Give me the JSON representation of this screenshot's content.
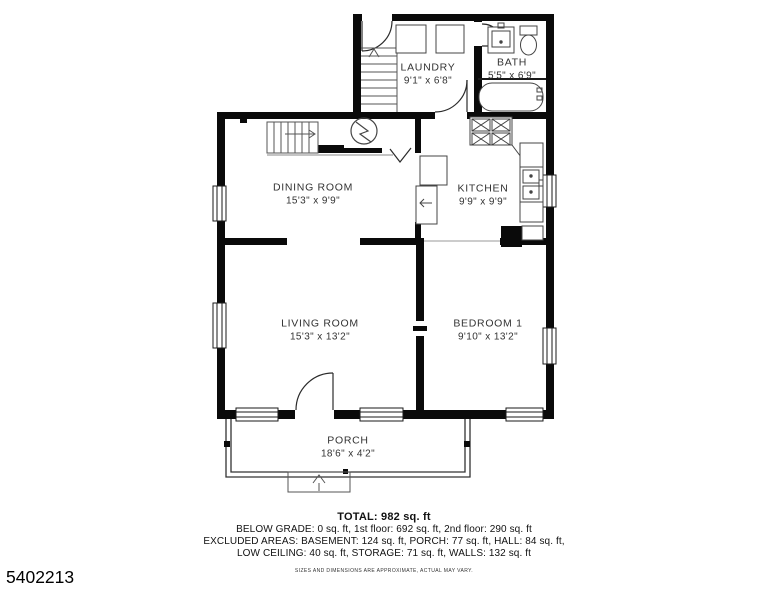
{
  "floor_plan": {
    "listing_id": "5402213",
    "rooms": [
      {
        "id": "laundry",
        "name": "LAUNDRY",
        "dims": "9'1\" x 6'8\""
      },
      {
        "id": "bath",
        "name": "BATH",
        "dims": "5'5\" x 6'9\""
      },
      {
        "id": "dining",
        "name": "DINING ROOM",
        "dims": "15'3\" x 9'9\""
      },
      {
        "id": "kitchen",
        "name": "KITCHEN",
        "dims": "9'9\" x 9'9\""
      },
      {
        "id": "living",
        "name": "LIVING ROOM",
        "dims": "15'3\" x 13'2\""
      },
      {
        "id": "bedroom",
        "name": "BEDROOM 1",
        "dims": "9'10\" x 13'2\""
      },
      {
        "id": "porch",
        "name": "PORCH",
        "dims": "18'6\" x 4'2\""
      }
    ],
    "summary": {
      "total": "TOTAL: 982 sq. ft",
      "line1": "BELOW GRADE: 0 sq. ft, 1st floor: 692 sq. ft, 2nd floor: 290 sq. ft",
      "line2": "EXCLUDED AREAS: BASEMENT: 124 sq. ft, PORCH: 77 sq. ft, HALL: 84 sq. ft,",
      "line3": "LOW CEILING: 40 sq. ft, STORAGE: 71 sq. ft, WALLS: 132 sq. ft",
      "disclaimer": "SIZES AND DIMENSIONS ARE APPROXIMATE, ACTUAL MAY VARY."
    },
    "colors": {
      "wall": "#0a0a0a",
      "fixture": "#3c3c3c",
      "text": "#2e2e2e"
    }
  }
}
